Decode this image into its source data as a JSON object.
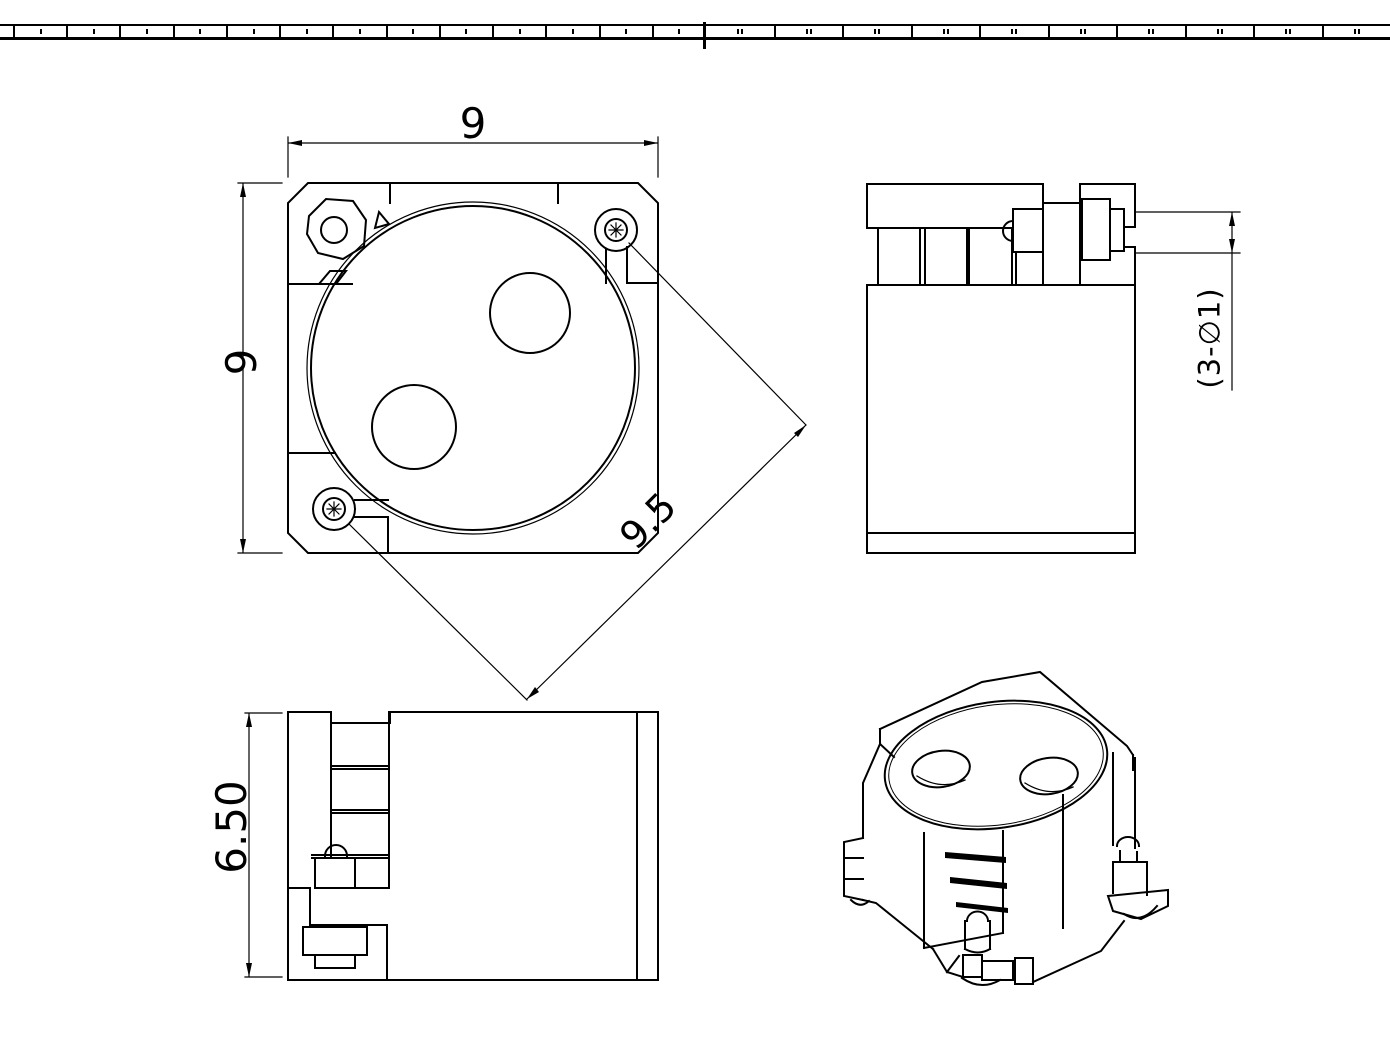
{
  "sheet": {
    "background": "#ffffff",
    "line_color": "#000000"
  },
  "zone_strip": {
    "left_cell_count": 13,
    "right_cell_count": 10
  },
  "dimensions": {
    "top_width": "9",
    "left_height": "9",
    "diagonal_pitch": "9.5",
    "front_height": "6.50",
    "hole_callout": "(3-∅1)"
  }
}
